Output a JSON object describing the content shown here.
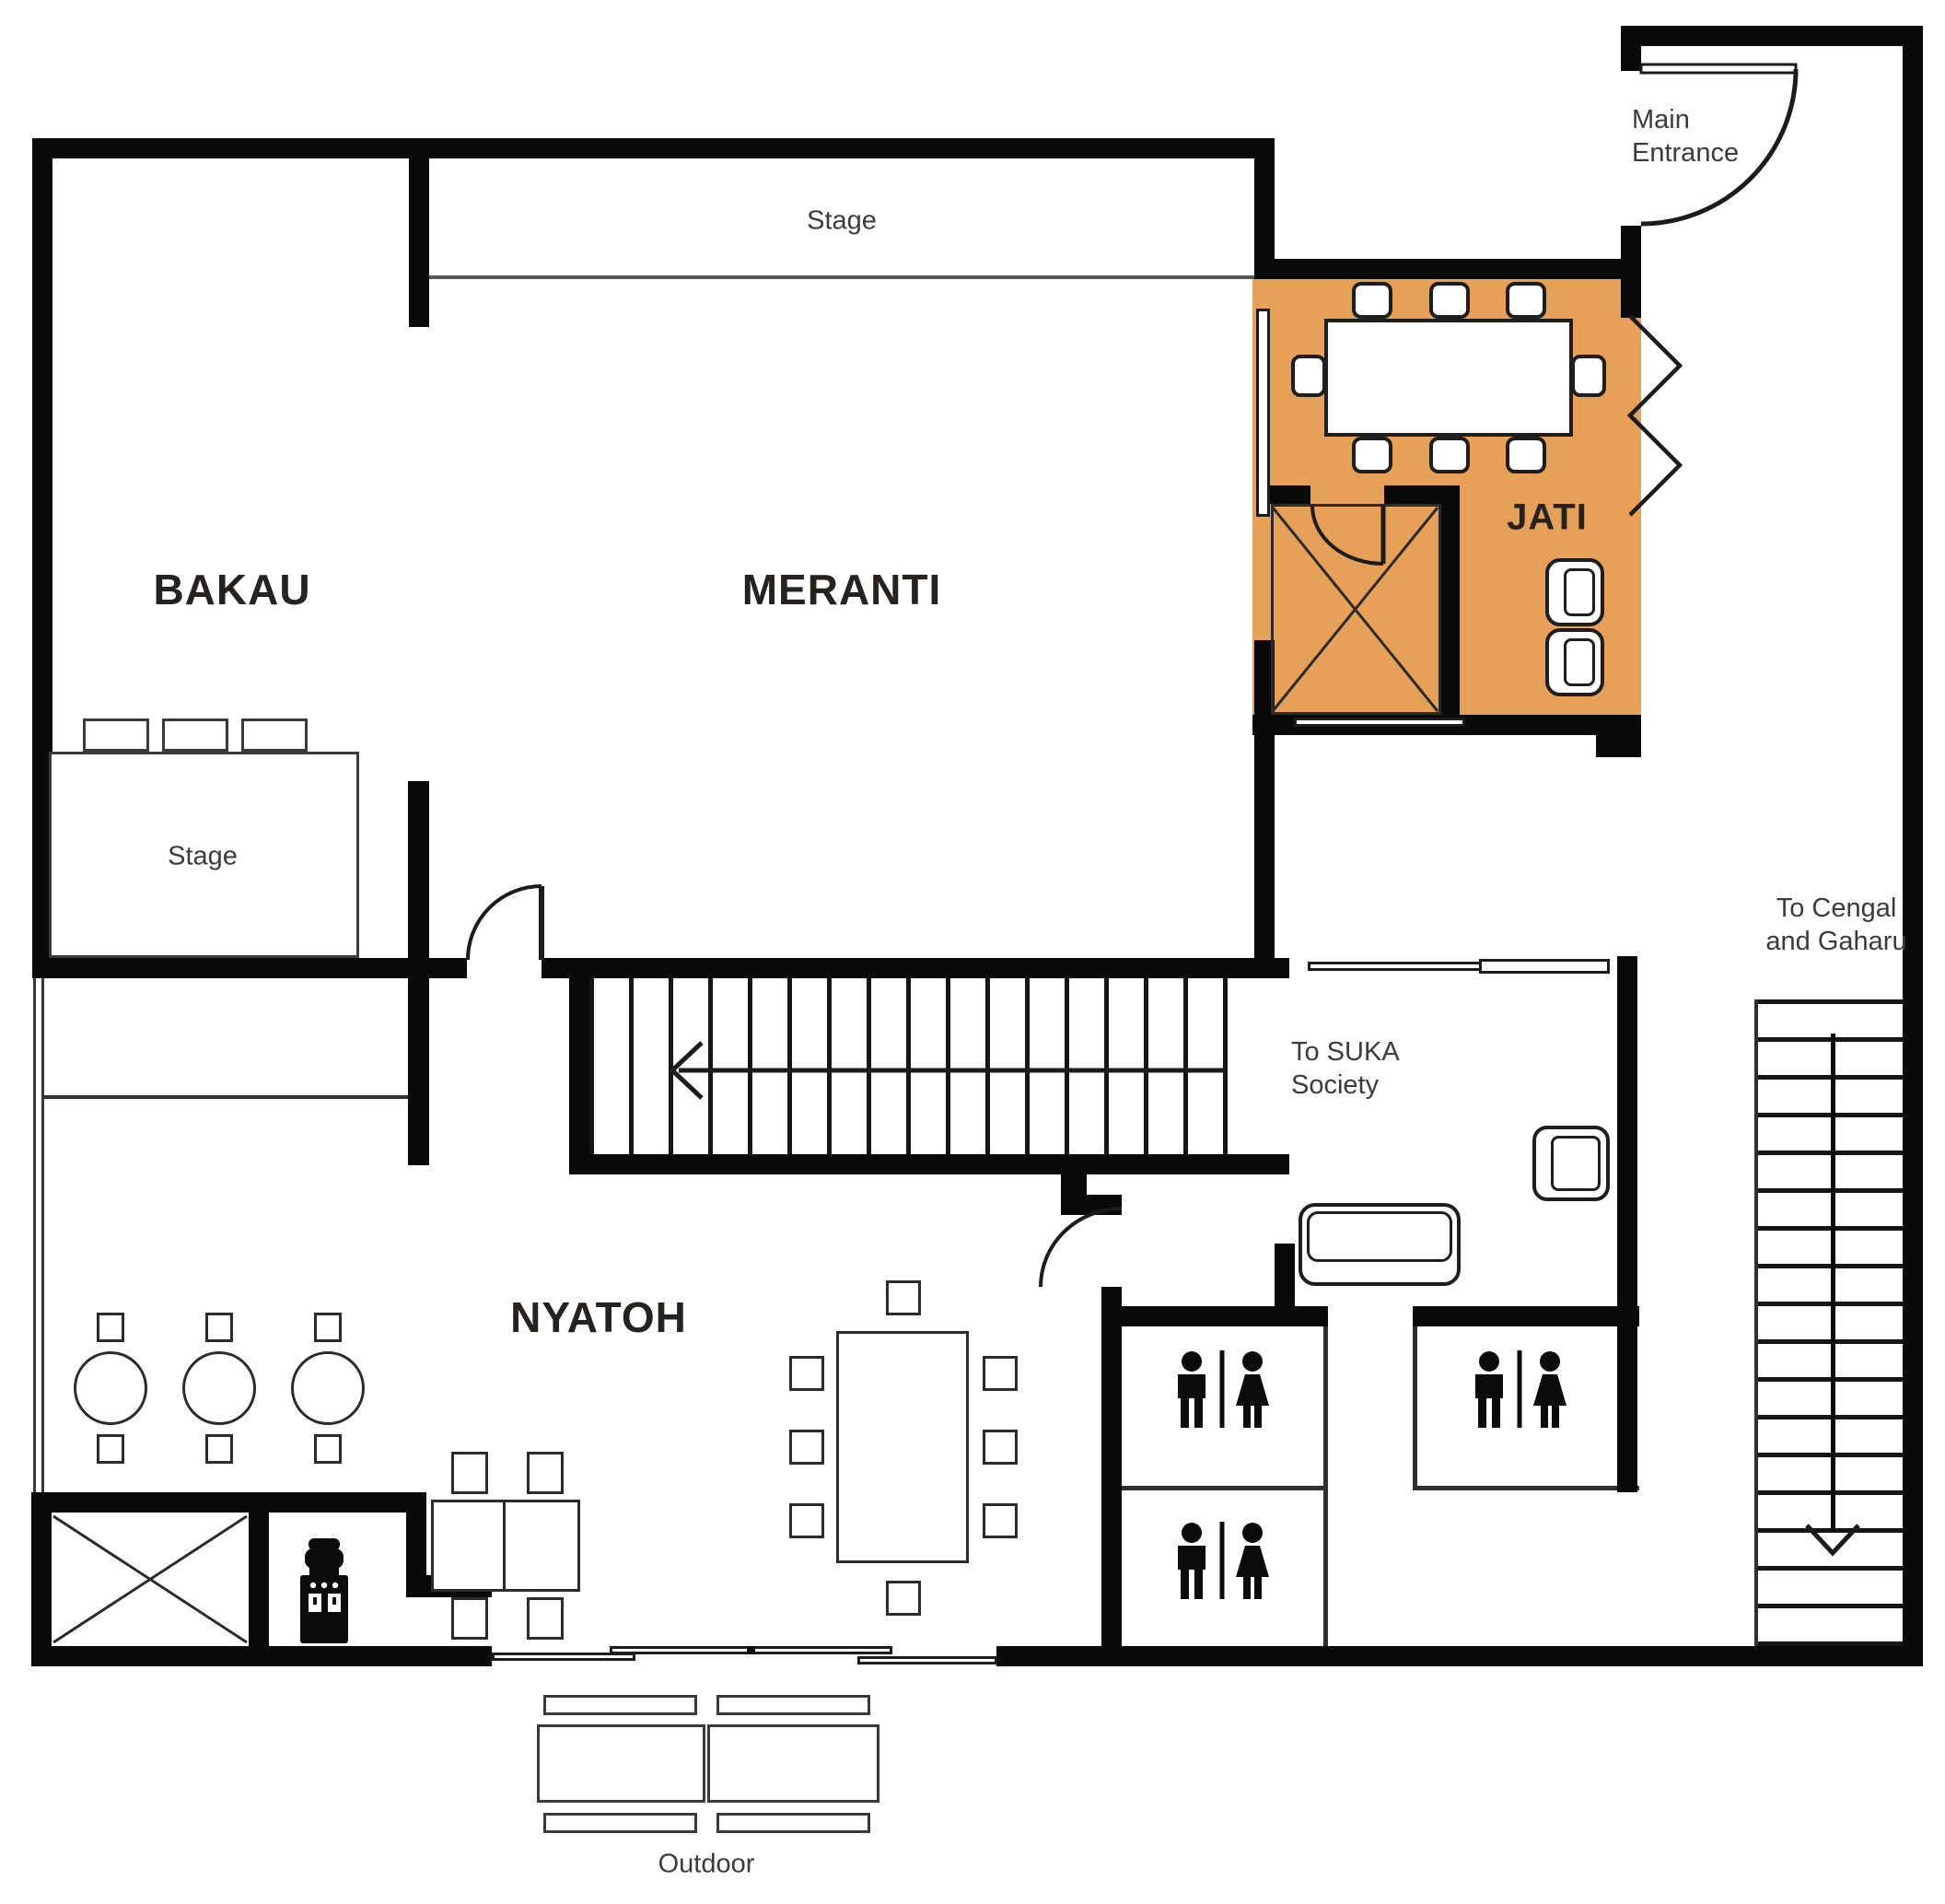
{
  "rooms": {
    "bakau": "BAKAU",
    "meranti": "MERANTI",
    "jati": "JATI",
    "nyatoh": "NYATOH"
  },
  "labels": {
    "stage_top": "Stage",
    "stage_left": "Stage",
    "main_entrance_line1": "Main",
    "main_entrance_line2": "Entrance",
    "suka_line1": "To SUKA",
    "suka_line2": "Society",
    "cengal_line1": "To Cengal",
    "cengal_line2": "and Gaharu",
    "outdoor": "Outdoor"
  },
  "icons": {
    "restroom": "male-female-restroom-icon",
    "water_dispenser": "water-dispenser-icon",
    "elevator": "elevator-x-icon",
    "stairs_exit_arrow": "stairs-exit-arrow-icon",
    "stairs_down_arrow": "stairs-down-arrow-icon",
    "door_swing": "door-swing-icon",
    "accordion_door": "accordion-folding-door-icon",
    "sliding_door": "sliding-door-icon"
  },
  "colors": {
    "jati_fill": "#E6A058",
    "wall": "#0A0A0B",
    "text": "#3B3B3A",
    "room_text": "#262220",
    "line": "#58595B"
  }
}
